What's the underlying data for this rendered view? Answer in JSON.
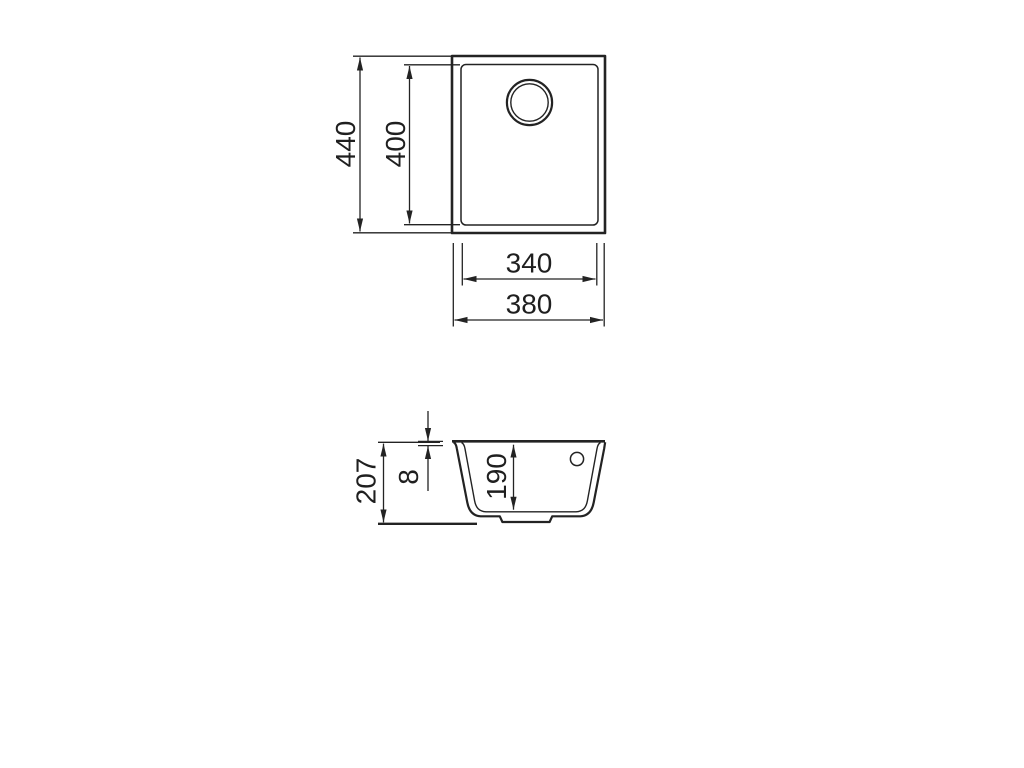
{
  "drawing": {
    "type": "technical-dimension-drawing",
    "subject": "undermount sink — top view and section view",
    "top_view": {
      "overall_height": "440",
      "bowl_height": "400",
      "bowl_width": "340",
      "overall_width": "380"
    },
    "section_view": {
      "overall_depth": "207",
      "rim_thickness": "8",
      "bowl_depth": "190"
    },
    "colors": {
      "line": "#232323",
      "background": "#ffffff"
    }
  }
}
